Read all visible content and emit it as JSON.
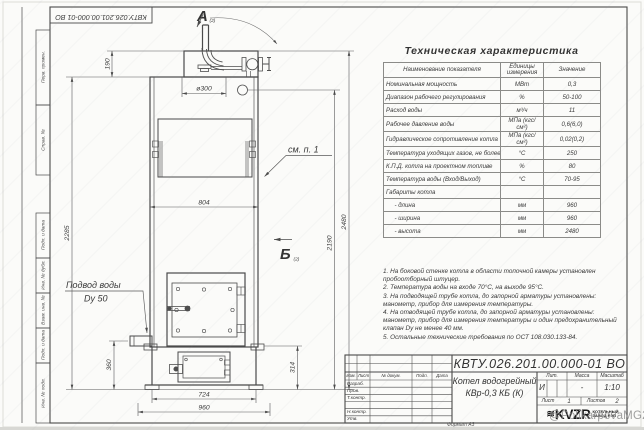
{
  "sheet": {
    "top_stamp": "КВТУ.026.201.00.000-01 ВО",
    "format_label": "Формат А3",
    "watermark": "@PolikarpovaMG2021",
    "border_fields": [
      "Перв. примен.",
      "Справ. №",
      "Подп. и дата",
      "Инв. № дубл.",
      "Взам. инв. №",
      "Подп. и дата",
      "Инв. № подл."
    ]
  },
  "drawing": {
    "view_a": "А",
    "view_a_ref": "(2)",
    "view_b": "Б",
    "view_b_ref": "(2)",
    "callout": "см. п. 1",
    "inlet_line1": "Подвод воды",
    "inlet_line2": "Dy 50",
    "dims": {
      "cap_height": "190",
      "flue_diameter": "ø300",
      "body_width": "804",
      "body_height": "2285",
      "fitting_height": "2190",
      "total_height": "2480",
      "inlet_height": "360",
      "base_height": "314",
      "base_inner_width": "724",
      "base_width": "960"
    }
  },
  "spec_table": {
    "title": "Техническая характеристика",
    "headers": [
      "Наименование показателя",
      "Единицы измерения",
      "Значение"
    ],
    "rows": [
      [
        "Номинальная мощность",
        "МВт",
        "0,3"
      ],
      [
        "Диапазон рабочего регулирования",
        "%",
        "50-100"
      ],
      [
        "Расход воды",
        "м³/ч",
        "11"
      ],
      [
        "Рабочее давление воды",
        "МПа (кгс/см²)",
        "0,6(6,0)"
      ],
      [
        "Гидравлическое сопротивление котла",
        "МПа (кгс/см²)",
        "0,02(0,2)"
      ],
      [
        "Температура уходящих газов, не более",
        "°С",
        "250"
      ],
      [
        "К.П.Д. котла на проектном топливе",
        "%",
        "80"
      ],
      [
        "Температура воды (Вход/Выход)",
        "°С",
        "70-95"
      ],
      [
        "Габариты котла",
        "",
        ""
      ],
      [
        "     - длина",
        "мм",
        "960"
      ],
      [
        "     - ширина",
        "мм",
        "960"
      ],
      [
        "     - высота",
        "мм",
        "2480"
      ]
    ]
  },
  "notes": [
    "1. На боковой стенке котла в области топочной камеры установлен пробоотборный штуцер.",
    "2. Температура воды на входе 70°С, на выходе 95°С.",
    "3. На подводящей трубе котла, до запорной арматуры установлены: манометр, прибор для измерения температуры.",
    "4. На отводящей трубе котла, до запорной арматуры установлены: манометр, прибор для измерения температуры и один предохранительный клапан Dy не менее 40 мм.",
    "5. Остальные технические требования по ОСТ 108.030.133-84."
  ],
  "title_block": {
    "doc_number": "КВТУ.026.201.00.000-01 ВО",
    "product_line1": "Котел водогрейный",
    "product_line2": "КВр-0,3 КБ (К)",
    "col_headers": [
      "Изм.",
      "Лист",
      "№ докум.",
      "Подп.",
      "Дата"
    ],
    "row_labels": [
      "Разраб.",
      "Пров.",
      "Т.контр.",
      "",
      "Н.контр.",
      "Утв."
    ],
    "lit_header": "Лит.",
    "mass_header": "Масса",
    "scale_header": "Масштаб",
    "lit_value": "И",
    "mass_value": "-",
    "scale_value": "1:10",
    "sheet_label": "Лист",
    "sheet_value": "1",
    "sheets_label": "Листов",
    "sheets_value": "2",
    "logo_mark": "≋",
    "logo_text": "KVZR",
    "company_line1": "КОТЕЛЬНЫЙ",
    "company_line2": "ЗАВОД РЭП"
  }
}
